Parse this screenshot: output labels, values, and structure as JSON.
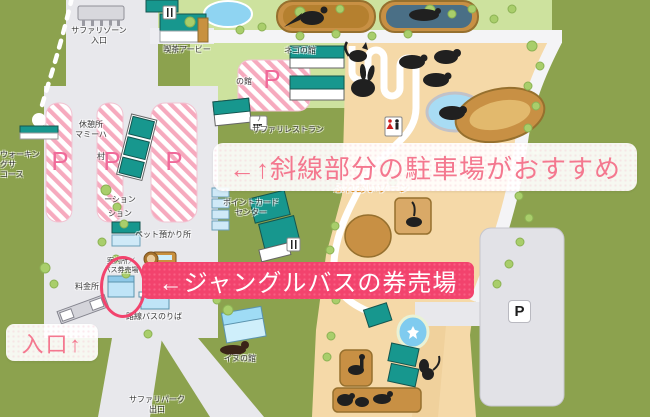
{
  "map": {
    "annotations": {
      "parking_recommend": "←↑斜線部分の駐車場がおすすめ",
      "bus_ticket_office": "←ジャングルバスの券売場",
      "entrance": "入口↑"
    },
    "labels": {
      "safari_zone_entrance": "サファリゾーン\n入口",
      "cafe_arby": "喫茶アービー",
      "rest_house": "休憩所\nマミーハ",
      "village_fragment": "村",
      "walking_course": "ウォーキングサ\nコース",
      "station_fragment_1": "ーション",
      "station_fragment_2": "ション",
      "pet_daycare": "ペット預かり所",
      "point_card_center": "ポイントカード\nセンター",
      "safari_restaurant": "サファリレストラン",
      "cat_house": "ネコの館",
      "house_fragment": "の館",
      "fureai_zone": "ふれあいゾーン",
      "info_bus_ticket": "案内所／\nバス券売場",
      "toll_gate": "料金所",
      "local_bus_stop": "路線バスのりば",
      "dog_house": "イヌの館",
      "safari_park_exit": "サファリパーク\n出口"
    },
    "parking": {
      "p1": "P",
      "p2": "P",
      "p3": "P",
      "p_center": "P",
      "p_sign": "P"
    },
    "colors": {
      "map_green": "#8ca24e",
      "field_green": "#cde29e",
      "sand": "#f5d9a8",
      "road_gray": "#e8e8ec",
      "stripe_pink": "#f6aabe",
      "accent_pink": "#f2436d",
      "note_pink": "#f4788f",
      "teal_building": "#17978e",
      "water_blue": "#8fd4f2",
      "pen_brown": "#c89044"
    }
  }
}
